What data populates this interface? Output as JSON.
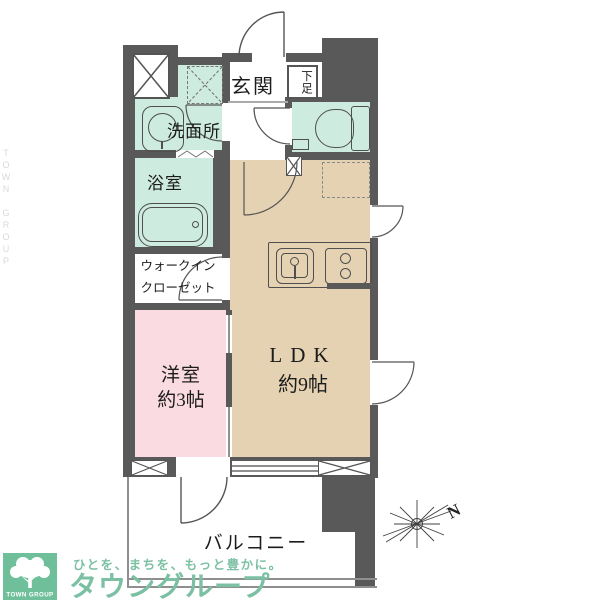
{
  "floorplan": {
    "rooms": {
      "entrance": "玄関",
      "shoe_box": "下足",
      "washroom": "洗面所",
      "bathroom": "浴室",
      "wic_line1": "ウォークイン",
      "wic_line2": "クローゼット",
      "western_room": "洋室",
      "western_room_size": "約3帖",
      "ldk": "LDK",
      "ldk_size": "約9帖",
      "balcony": "バルコニー"
    },
    "compass": {
      "north_label": "N"
    },
    "colors": {
      "wall": "#595959",
      "wet_area": "#cdebdf",
      "ldk_floor": "#e4d2b2",
      "western_room_floor": "#fadbe1",
      "brand_green": "#7cc0a4"
    }
  },
  "branding": {
    "logo_text": "TOWN GROUP",
    "tagline": "ひとを、まちを、もっと豊かに。",
    "brand_name": "タウングループ",
    "watermark": "TOWN GROUP"
  }
}
